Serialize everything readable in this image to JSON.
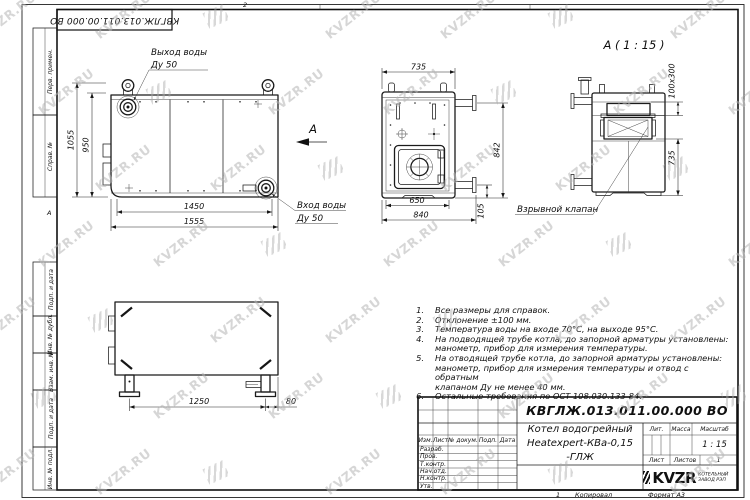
{
  "watermark": {
    "text": "KVZR.RU"
  },
  "frame": {
    "doc_number_top": "КВГЛЖ.013.011.00.000 ВО",
    "zone_top": "2",
    "zone_left": "А",
    "left_columns": {
      "col1": "Перв. примен.",
      "col2": "Справ. №",
      "col3": "Подп. и дата",
      "col4": "Инв. № дубл.",
      "col5": "Взам. инв. №",
      "col6": "Подп. и дата",
      "col7": "Инв. № подл."
    }
  },
  "views": {
    "front": {
      "outlet_label_line1": "Выход воды",
      "outlet_label_line2": "Ду 50",
      "inlet_label_line1": "Вход воды",
      "inlet_label_line2": "Ду 50",
      "view_arrow_label": "А",
      "dim_height_overall": "1055",
      "dim_height_inner": "950",
      "dim_width_inner": "1450",
      "dim_width_overall": "1555"
    },
    "side": {
      "dim_width_top": "735",
      "dim_width_inner": "650",
      "dim_width_overall": "840",
      "dim_height_right": "842",
      "dim_pipe_offset": "105"
    },
    "detail": {
      "title": "А ( 1 : 15 )",
      "dim_valve_size": "100x300",
      "dim_height": "735",
      "callout": "Взрывной клапан"
    },
    "plan": {
      "dim_leg_span": "1250",
      "dim_overhang": "80"
    }
  },
  "notes": {
    "items": [
      {
        "num": "1.",
        "text": "Все размеры для справок."
      },
      {
        "num": "2.",
        "text": "Отклонение ±100 мм."
      },
      {
        "num": "3.",
        "text": "Температура воды на входе 70°С, на выходе 95°С."
      },
      {
        "num": "4.",
        "text": "На подводящей трубе котла, до запорной арматуры установлены:\nманометр, прибор для измерения температуры."
      },
      {
        "num": "5.",
        "text": "На отводящей трубе котла, до запорной арматуры установлены:\nманометр, прибор для измерения температуры и отвод с обратным\nклапаном Ду не менее 40 мм."
      },
      {
        "num": "6.",
        "text": "Остальные требования по ОСТ 108.030.133-84."
      }
    ]
  },
  "title_block": {
    "doc_number": "КВГЛЖ.013.011.00.000 ВО",
    "product_name": "Котел водогрейный\nHeatexpert-КВа-0,15 -ГЛЖ",
    "header": {
      "izm": "Изм.",
      "list": "Лист",
      "doc": "№ докум.",
      "podp": "Подп.",
      "data": "Дата"
    },
    "rows": [
      "Разраб.",
      "Пров.",
      "Т.контр.",
      "Нач.отд.",
      "Н.контр.",
      "Утв."
    ],
    "lit_label": "Лит.",
    "mass_label": "Масса",
    "scale_label": "Масштаб",
    "scale_value": "1 : 15",
    "sheet_label": "Лист",
    "sheets_label": "Листов",
    "sheets_value": "1",
    "logo_text": "KVZR",
    "logo_sub1": "КОТЕЛЬНЫЙ",
    "logo_sub2": "ЗАВОД РЭП",
    "copy_num": "1",
    "copied_label": "Копировал",
    "format_label": "Формат А3"
  }
}
